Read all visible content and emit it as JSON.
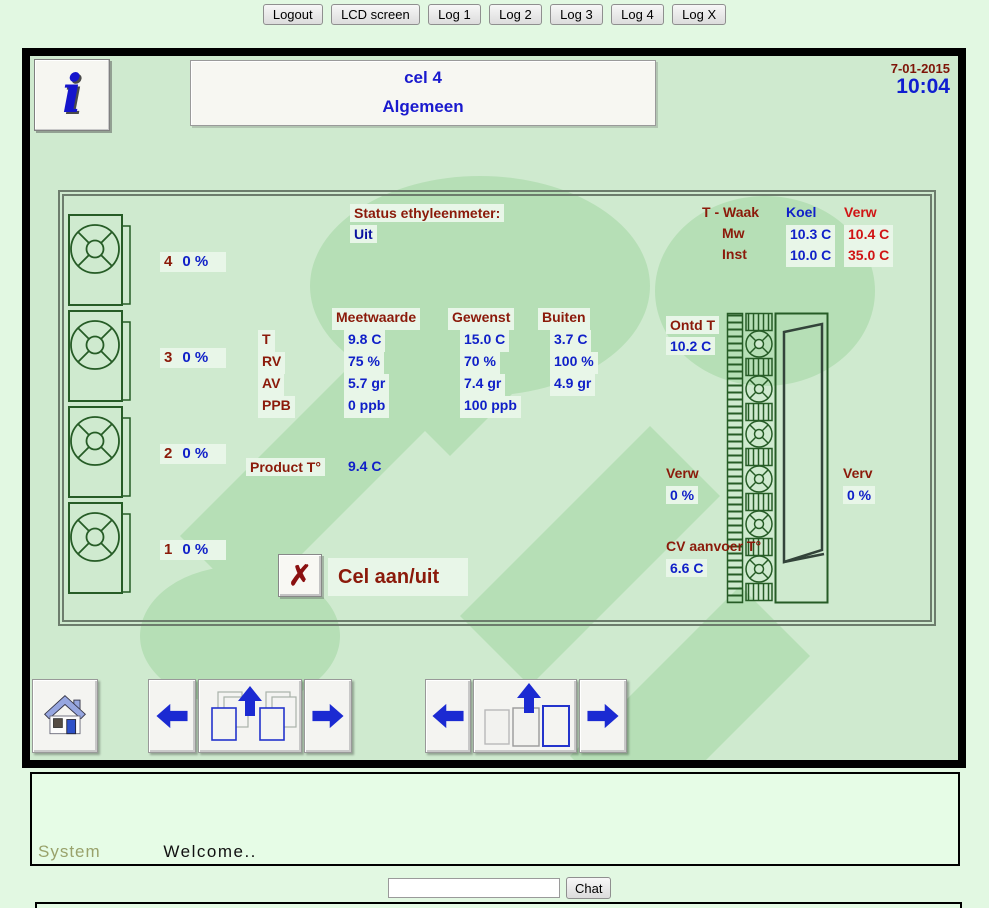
{
  "toolbar": {
    "buttons": [
      "Logout",
      "LCD screen",
      "Log 1",
      "Log 2",
      "Log 3",
      "Log 4",
      "Log X"
    ]
  },
  "header": {
    "info_glyph": "i",
    "title_line1": "cel 4",
    "title_line2": "Algemeen",
    "date": "7-01-2015",
    "time": "10:04"
  },
  "status": {
    "label": "Status ethyleenmeter:",
    "value": "Uit"
  },
  "twaak": {
    "title": "T - Waak",
    "col_koel": "Koel",
    "col_verw": "Verw",
    "rows": [
      {
        "label": "Mw",
        "koel": "10.3 C",
        "verw": "10.4 C"
      },
      {
        "label": "Inst",
        "koel": "10.0 C",
        "verw": "35.0 C"
      }
    ]
  },
  "fans": [
    {
      "number": "4",
      "value": "0 %"
    },
    {
      "number": "3",
      "value": "0 %"
    },
    {
      "number": "2",
      "value": "0 %"
    },
    {
      "number": "1",
      "value": "0 %"
    }
  ],
  "measurements": {
    "headers": [
      "Meetwaarde",
      "Gewenst",
      "Buiten"
    ],
    "rows": [
      {
        "label": "T",
        "cols": [
          "9.8 C",
          "15.0 C",
          "3.7 C"
        ]
      },
      {
        "label": "RV",
        "cols": [
          "75 %",
          "70 %",
          "100 %"
        ]
      },
      {
        "label": "AV",
        "cols": [
          "5.7 gr",
          "7.4 gr",
          "4.9 gr"
        ]
      },
      {
        "label": "PPB",
        "cols": [
          "0 ppb",
          "100 ppb",
          ""
        ]
      }
    ]
  },
  "product": {
    "label": "Product T°",
    "value": "9.4 C"
  },
  "cell_switch": {
    "icon": "✗",
    "label": "Cel aan/uit"
  },
  "ontd": {
    "label": "Ontd T",
    "value": "10.2 C"
  },
  "verw": {
    "label": "Verw",
    "value": "0 %"
  },
  "verv": {
    "label": "Verv",
    "value": "0 %"
  },
  "cv": {
    "label": "CV aanvoer T°",
    "value": "6.6 C"
  },
  "chat": {
    "sender": "System",
    "message": "Welcome..",
    "input_value": "",
    "button_label": "Chat"
  },
  "colors": {
    "page_bg": "#e2f8e2",
    "panel_bg": "#cfeacf",
    "watermark_green": "#b6dfb6",
    "label_red": "#8b1a0a",
    "value_blue": "#1020c8",
    "warm_red": "#d01414",
    "title_blue": "#1a1ace",
    "date_red": "#7e1408",
    "time_blue": "#0f1ed0",
    "diagram_stroke": "#265c26",
    "highlight": "#e8f6e8"
  }
}
